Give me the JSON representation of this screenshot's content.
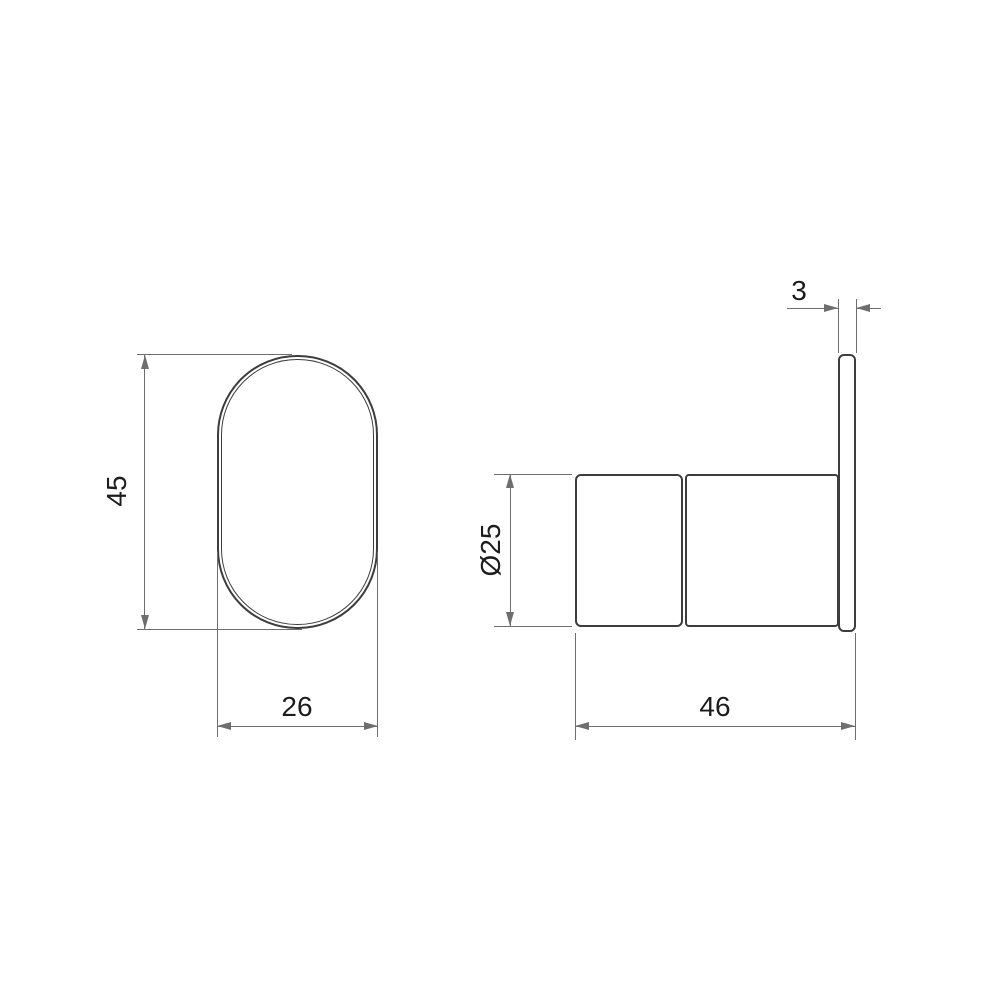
{
  "drawing": {
    "front_view": {
      "height_dim": "45",
      "width_dim": "26"
    },
    "side_view": {
      "diameter_dim": "Ø25",
      "plate_thickness_dim": "3",
      "depth_dim": "46"
    },
    "colors": {
      "background": "#ffffff",
      "object_line": "#3d3d3d",
      "dimension_line": "#6e6e6e",
      "text": "#1c1c1c"
    }
  }
}
